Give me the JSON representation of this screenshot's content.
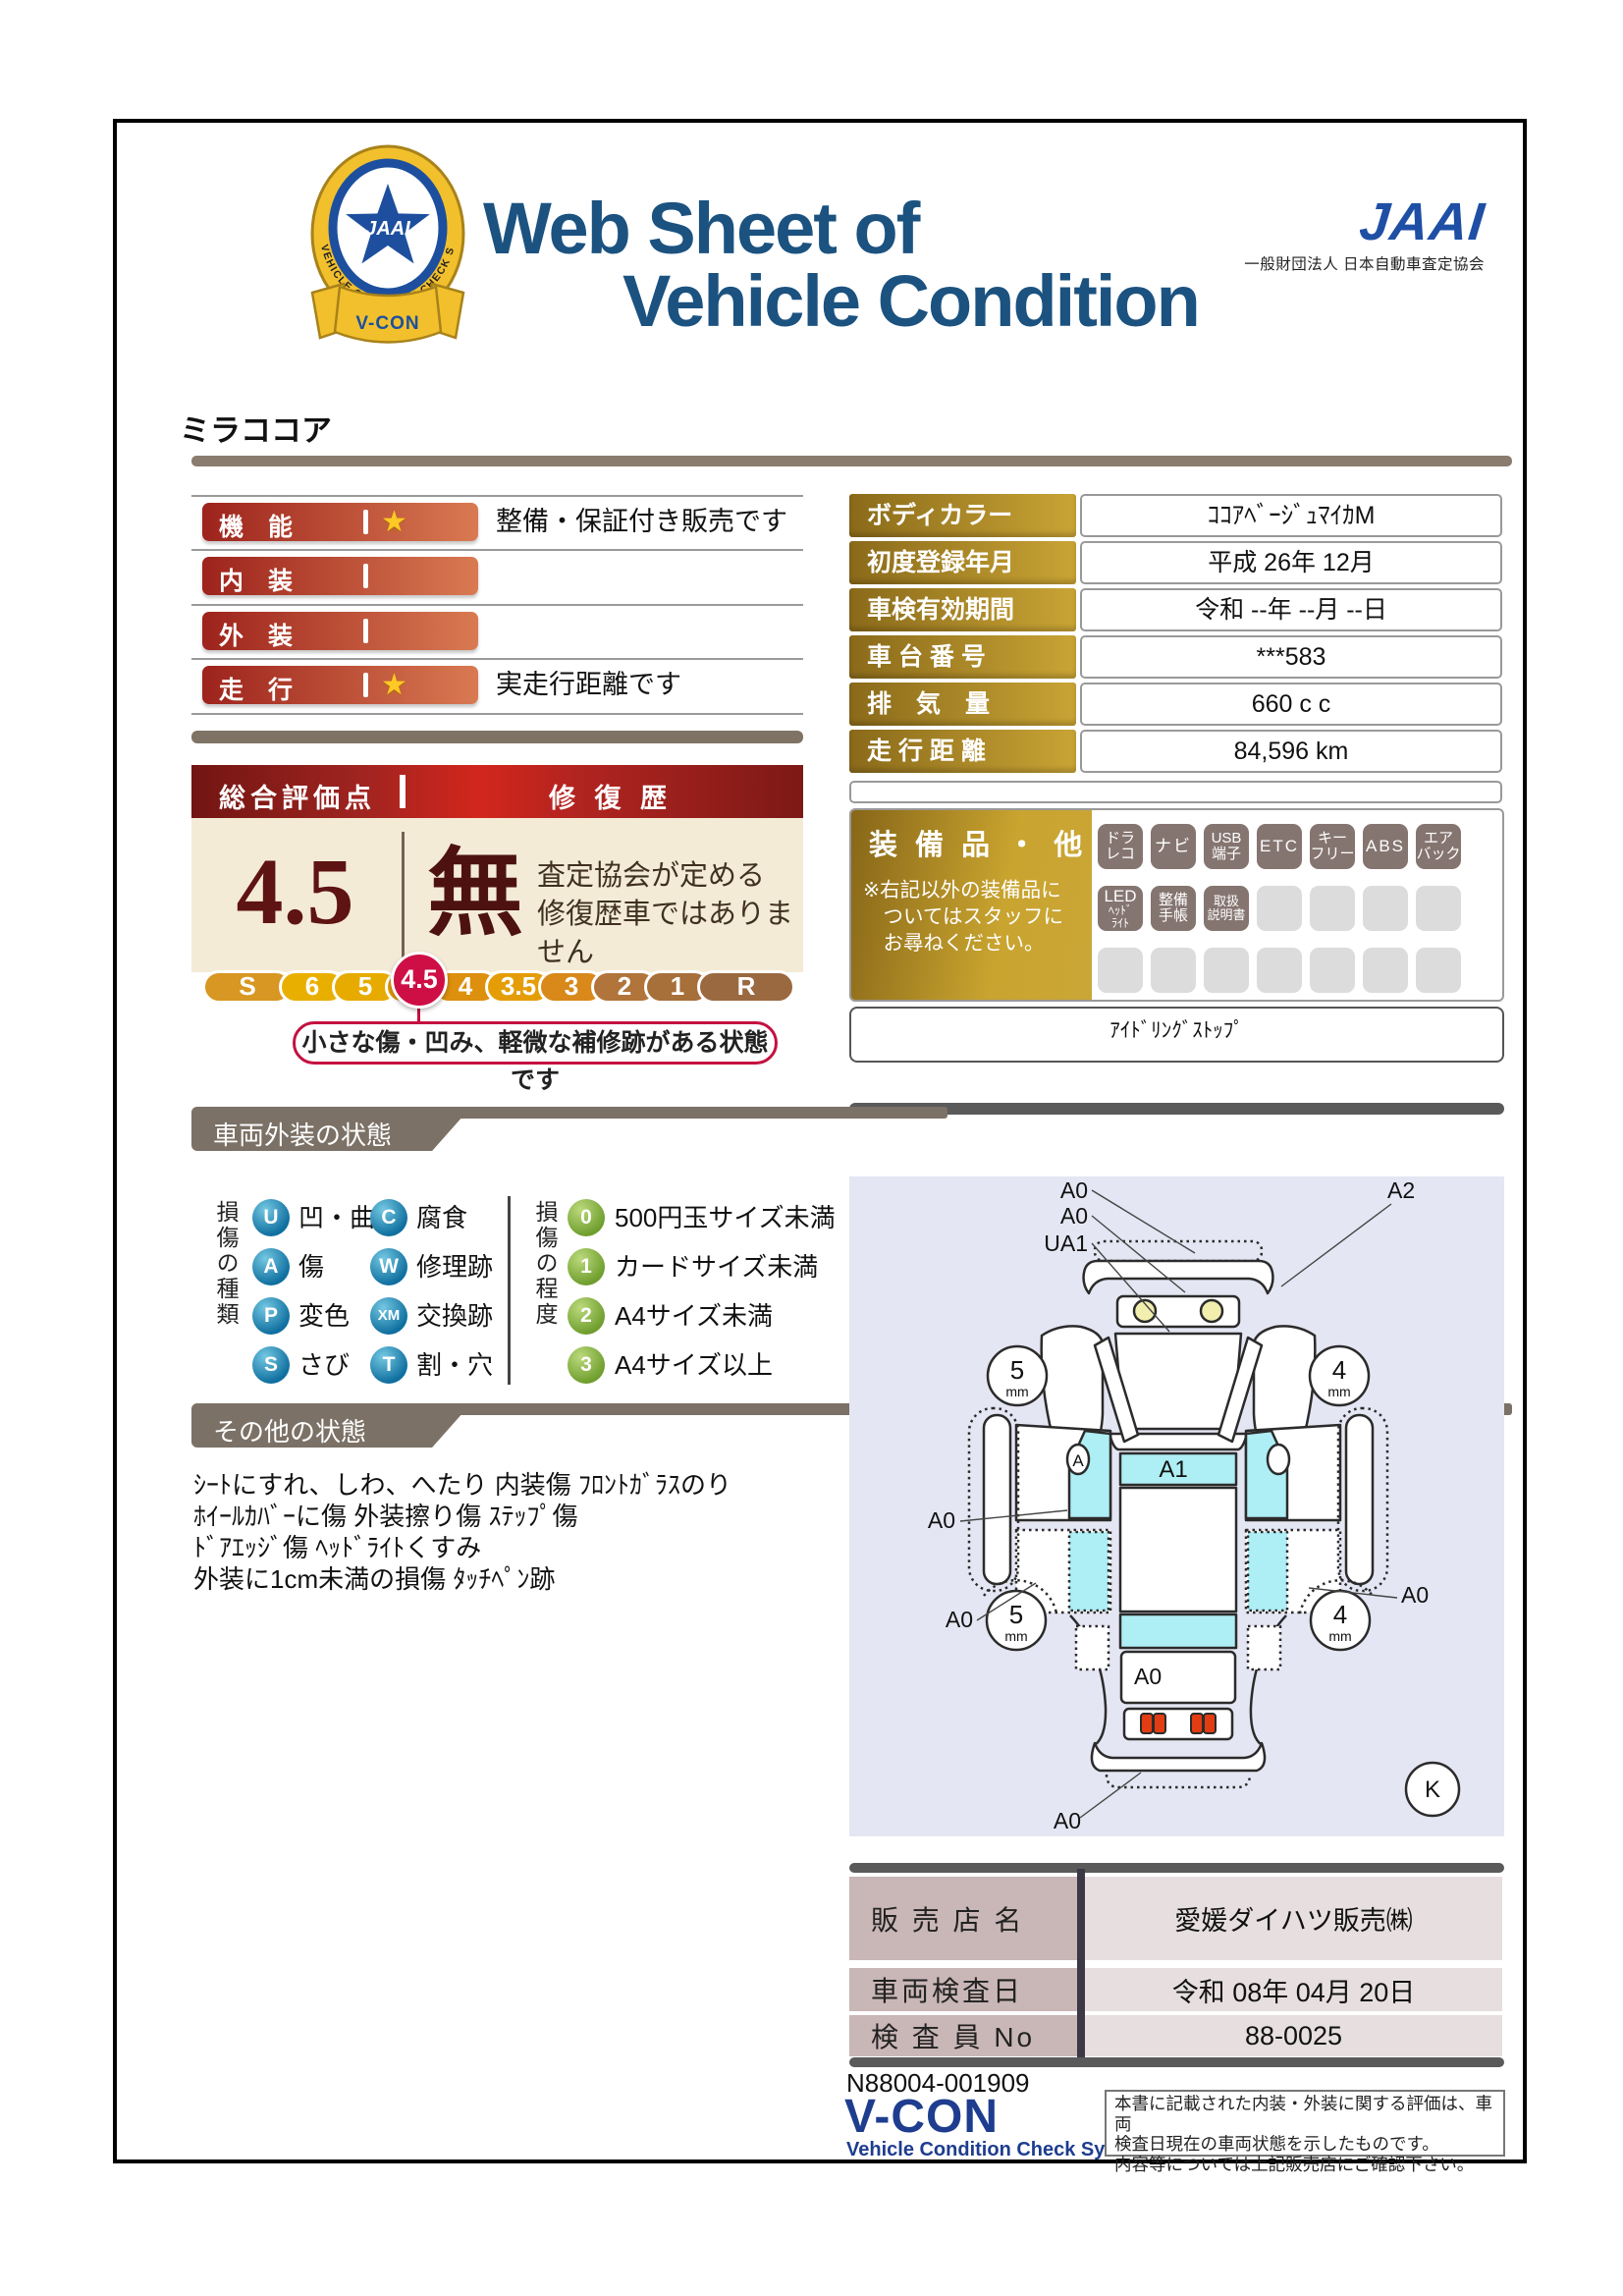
{
  "colors": {
    "navy": "#1b5280",
    "jaai_blue": "#1e4fa5",
    "red1": "#9d231c",
    "red2": "#d97a52",
    "crimson": "#ce0f45",
    "gold1": "#8a6a1a",
    "gold2": "#c9a435",
    "ribbon": "#7b7166",
    "table_label": "#c9b6b6",
    "table_value": "#e7dfdf",
    "footer_navy": "#1e3d8f"
  },
  "header": {
    "title_line1": "Web Sheet of",
    "title_line2": "Vehicle Condition",
    "jaai_logo": "JAAI",
    "jaai_subtitle": "一般財団法人 日本自動車査定協会",
    "badge_ring_text": "VEHICLE CONDITION CHECK SYSTEM",
    "badge_emblem_text": "JAAI",
    "badge_ribbon_text": "V-CON"
  },
  "model_name": "ミラココア",
  "ratings": [
    {
      "label": "機　能",
      "star": "★",
      "note": "整備・保証付き販売です"
    },
    {
      "label": "内　装",
      "star": "",
      "note": ""
    },
    {
      "label": "外　装",
      "star": "",
      "note": ""
    },
    {
      "label": "走　行",
      "star": "★",
      "note": "実走行距離です"
    }
  ],
  "overall": {
    "header_left": "総合評価点",
    "header_right": "修 復 歴",
    "score": "4.5",
    "repair_flag": "無",
    "repair_note_line1": "査定協会が定める",
    "repair_note_line2": "修復歴車ではありません",
    "scale": [
      "S",
      "6",
      "5",
      "4.5",
      "4",
      "3.5",
      "3",
      "2",
      "1",
      "R"
    ],
    "scale_selected": "4.5",
    "scale_caption": "小さな傷・凹み、軽微な補修跡がある状態です"
  },
  "vehicle_info": {
    "rows": [
      {
        "label": "ボディカラー",
        "value": "ｺｺｱﾍﾞｰｼﾞｭﾏｲｶM"
      },
      {
        "label": "初度登録年月",
        "value": "平成 26年 12月"
      },
      {
        "label": "車検有効期間",
        "value": "令和 --年 --月 --日"
      },
      {
        "label": "車 台 番 号",
        "value": "***583"
      },
      {
        "label": "排　気　量",
        "value": "660 c c"
      },
      {
        "label": "走 行 距 離",
        "value": "84,596 km"
      }
    ]
  },
  "equipment": {
    "title": "装 備 品 ・ 他",
    "note_line1": "※右記以外の装備品に",
    "note_line2": "　ついてはスタッフに",
    "note_line3": "　お尋ねください。",
    "badges": [
      [
        "ドラ",
        "レコ"
      ],
      [
        "ナビ"
      ],
      [
        "USB",
        "端子"
      ],
      [
        "ETC"
      ],
      [
        "キー",
        "フリー"
      ],
      [
        "ABS"
      ],
      [
        "エア",
        "バック"
      ],
      [
        "LED",
        "ﾍｯﾄﾞ",
        "ﾗｲﾄ"
      ],
      [
        "整備",
        "手帳"
      ],
      [
        "取扱",
        "説明書"
      ]
    ],
    "extra": "ｱｲﾄﾞﾘﾝｸﾞｽﾄｯﾌﾟ"
  },
  "exterior": {
    "title": "車両外装の状態",
    "type_title": "損傷の種類",
    "types": [
      {
        "code": "U",
        "label": "凹・曲"
      },
      {
        "code": "C",
        "label": "腐食"
      },
      {
        "code": "A",
        "label": "傷"
      },
      {
        "code": "W",
        "label": "修理跡"
      },
      {
        "code": "P",
        "label": "変色"
      },
      {
        "code": "XM",
        "label": "交換跡"
      },
      {
        "code": "S",
        "label": "さび"
      },
      {
        "code": "T",
        "label": "割・穴"
      }
    ],
    "degree_title": "損傷の程度",
    "degrees": [
      {
        "code": "0",
        "label": "500円玉サイズ未満"
      },
      {
        "code": "1",
        "label": "カードサイズ未満"
      },
      {
        "code": "2",
        "label": "A4サイズ未満"
      },
      {
        "code": "3",
        "label": "A4サイズ以上"
      }
    ]
  },
  "other": {
    "title": "その他の状態",
    "lines": [
      "ｼｰﾄにすれ、しわ、へたり 内装傷 ﾌﾛﾝﾄｶﾞﾗｽのり",
      "ﾎｲｰﾙｶﾊﾞｰに傷 外装擦り傷 ｽﾃｯﾌﾟ傷",
      "ﾄﾞｱｴｯｼﾞ傷 ﾍｯﾄﾞﾗｲﾄくすみ",
      "外装に1cm未満の損傷 ﾀｯﾁﾍﾟﾝ跡"
    ]
  },
  "diagram": {
    "front_labels": [
      "A0",
      "A0",
      "UA1"
    ],
    "front_right_label": "A2",
    "roof_label": "A1",
    "door_mark": "A",
    "tire_front_left": "5",
    "tire_front_right": "4",
    "tire_rear_left": "5",
    "tire_rear_right": "4",
    "tire_unit": "mm",
    "side_left_label": "A0",
    "side_left_lower_label": "A0",
    "side_right_label": "A0",
    "trunk_label": "A0",
    "rear_bottom_label": "A0",
    "corner_mark": "K"
  },
  "dealer": {
    "rows": [
      {
        "label": "販 売 店 名",
        "value": "愛媛ダイハツ販売㈱"
      },
      {
        "label": "車両検査日",
        "value": "令和 08年 04月 20日"
      },
      {
        "label": "検 査 員 No",
        "value": "88-0025"
      }
    ]
  },
  "footer": {
    "serial": "N88004-001909",
    "vcon": "V-CON",
    "vcon_subtitle": "Vehicle Condition Check System",
    "disclaimer_line1": "本書に記載された内装・外装に関する評価は、車両",
    "disclaimer_line2": "検査日現在の車両状態を示したものです。",
    "disclaimer_line3": "内容等については上記販売店にご確認下さい。"
  }
}
